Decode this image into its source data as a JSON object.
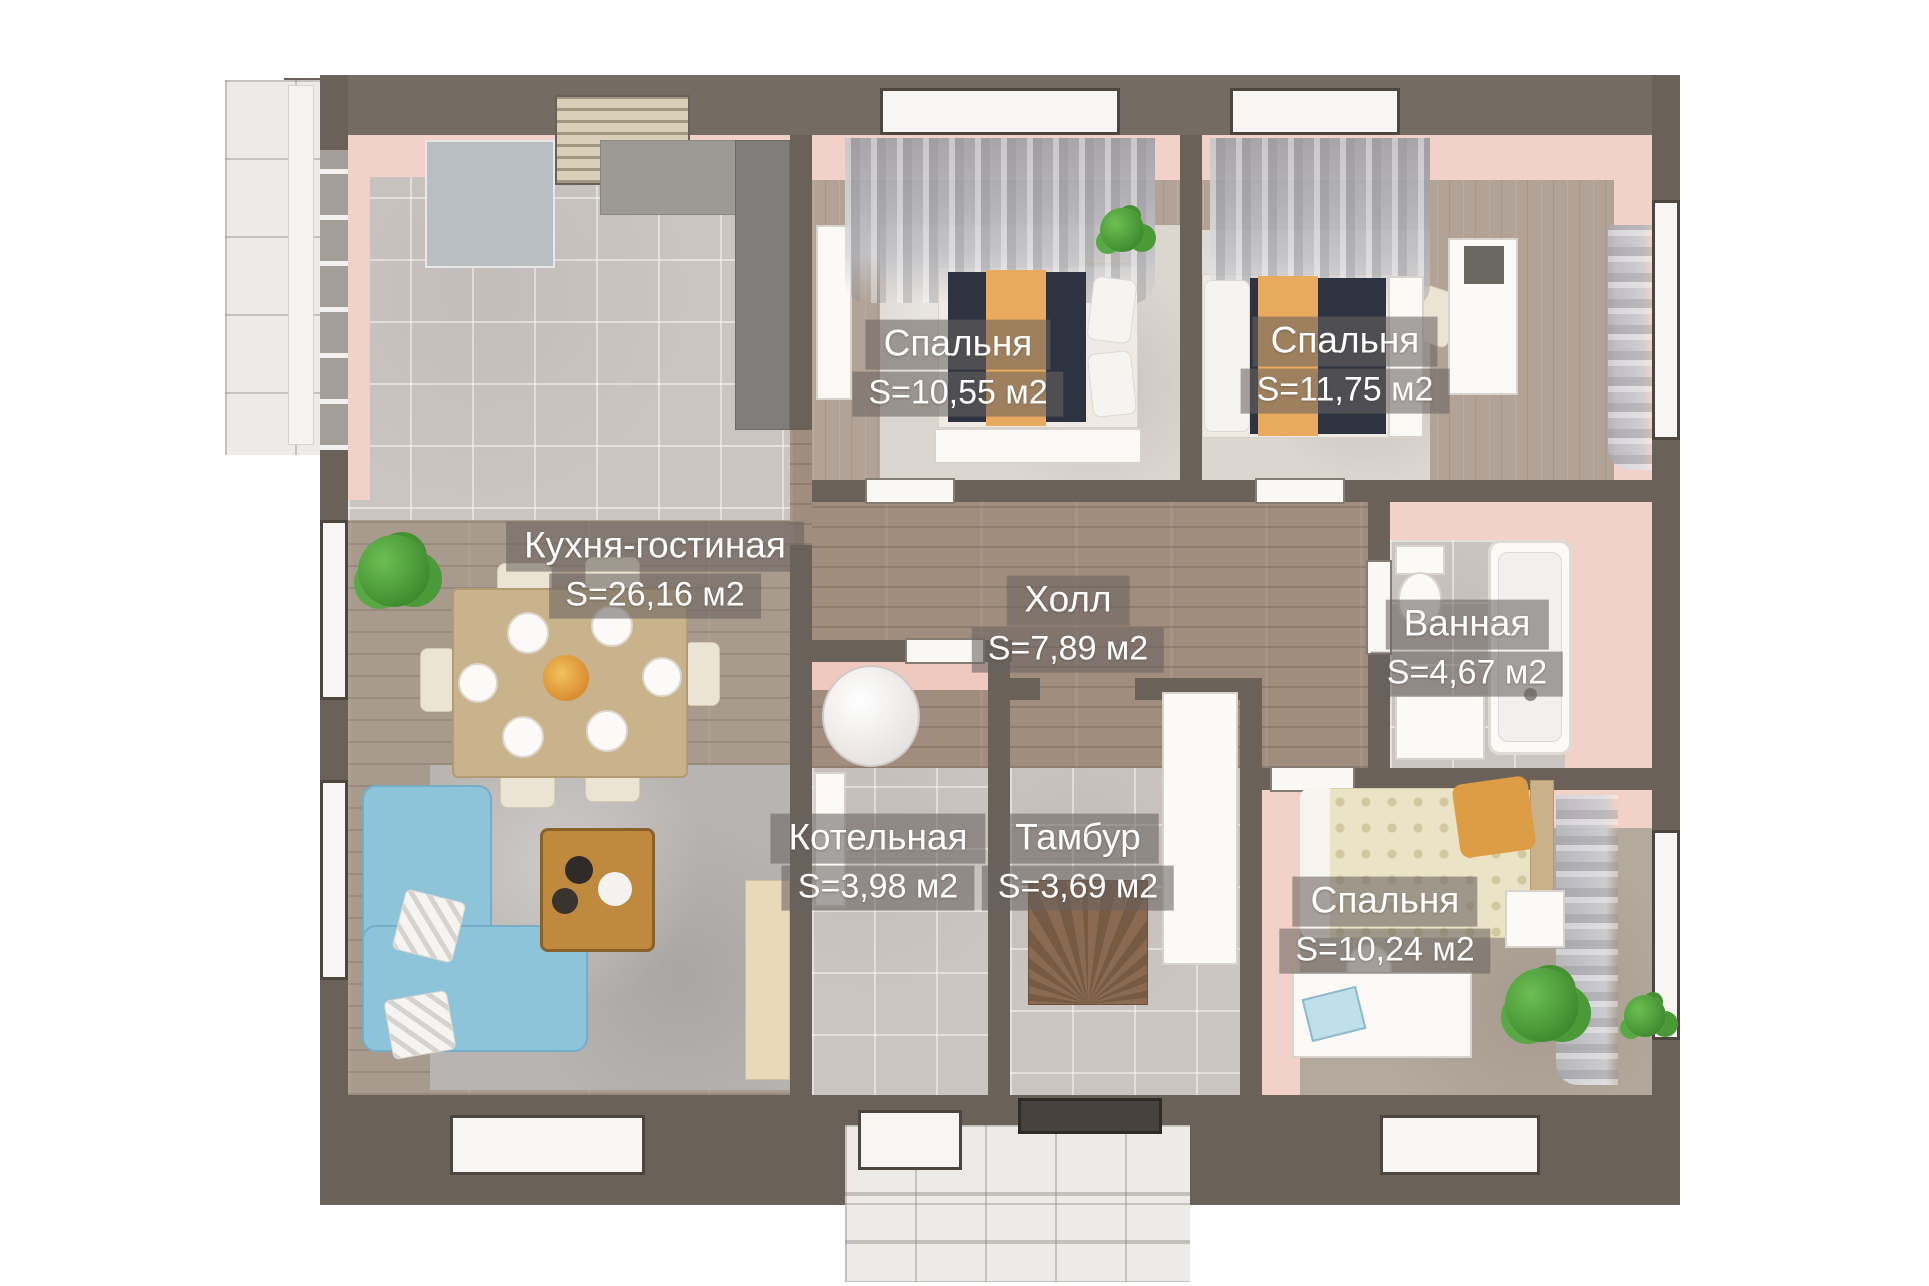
{
  "plan": {
    "kind": "3d-floor-plan-top-view",
    "language": "ru"
  },
  "rooms": [
    {
      "id": "bedroom-top-left",
      "name": "Спальня",
      "area": "S=10,55 м2"
    },
    {
      "id": "bedroom-top-right",
      "name": "Спальня",
      "area": "S=11,75 м2"
    },
    {
      "id": "kitchen-living",
      "name": "Кухня-гостиная",
      "area": "S=26,16 м2"
    },
    {
      "id": "hall",
      "name": "Холл",
      "area": "S=7,89 м2"
    },
    {
      "id": "bathroom",
      "name": "Ванная",
      "area": "S=4,67 м2"
    },
    {
      "id": "boiler-room",
      "name": "Котельная",
      "area": "S=3,98 м2"
    },
    {
      "id": "vestibule",
      "name": "Тамбур",
      "area": "S=3,69 м2"
    },
    {
      "id": "bedroom-bottom-right",
      "name": "Спальня",
      "area": "S=10,24 м2"
    }
  ],
  "colors": {
    "wall_dark": "#6a6159",
    "wall_pink": "#f2d1c8",
    "floor_tile_gray": "#cbc5c1",
    "floor_wood_bedroom": "#b2a396",
    "floor_wood_hall": "#a08d7e",
    "floor_porch_tile": "#edebe7",
    "sofa_blue": "#8ec4d9",
    "bed_cover_dark": "#2d3340",
    "blanket_orange": "#e9a95e",
    "quilt_cream": "#eae3c5",
    "dining_table_wood": "#c9b38c",
    "coffee_table_wood": "#bf8a3e",
    "plant_green": "#4a9a38",
    "label_background": "rgba(105,99,94,0.58)",
    "label_text": "#ffffff"
  }
}
